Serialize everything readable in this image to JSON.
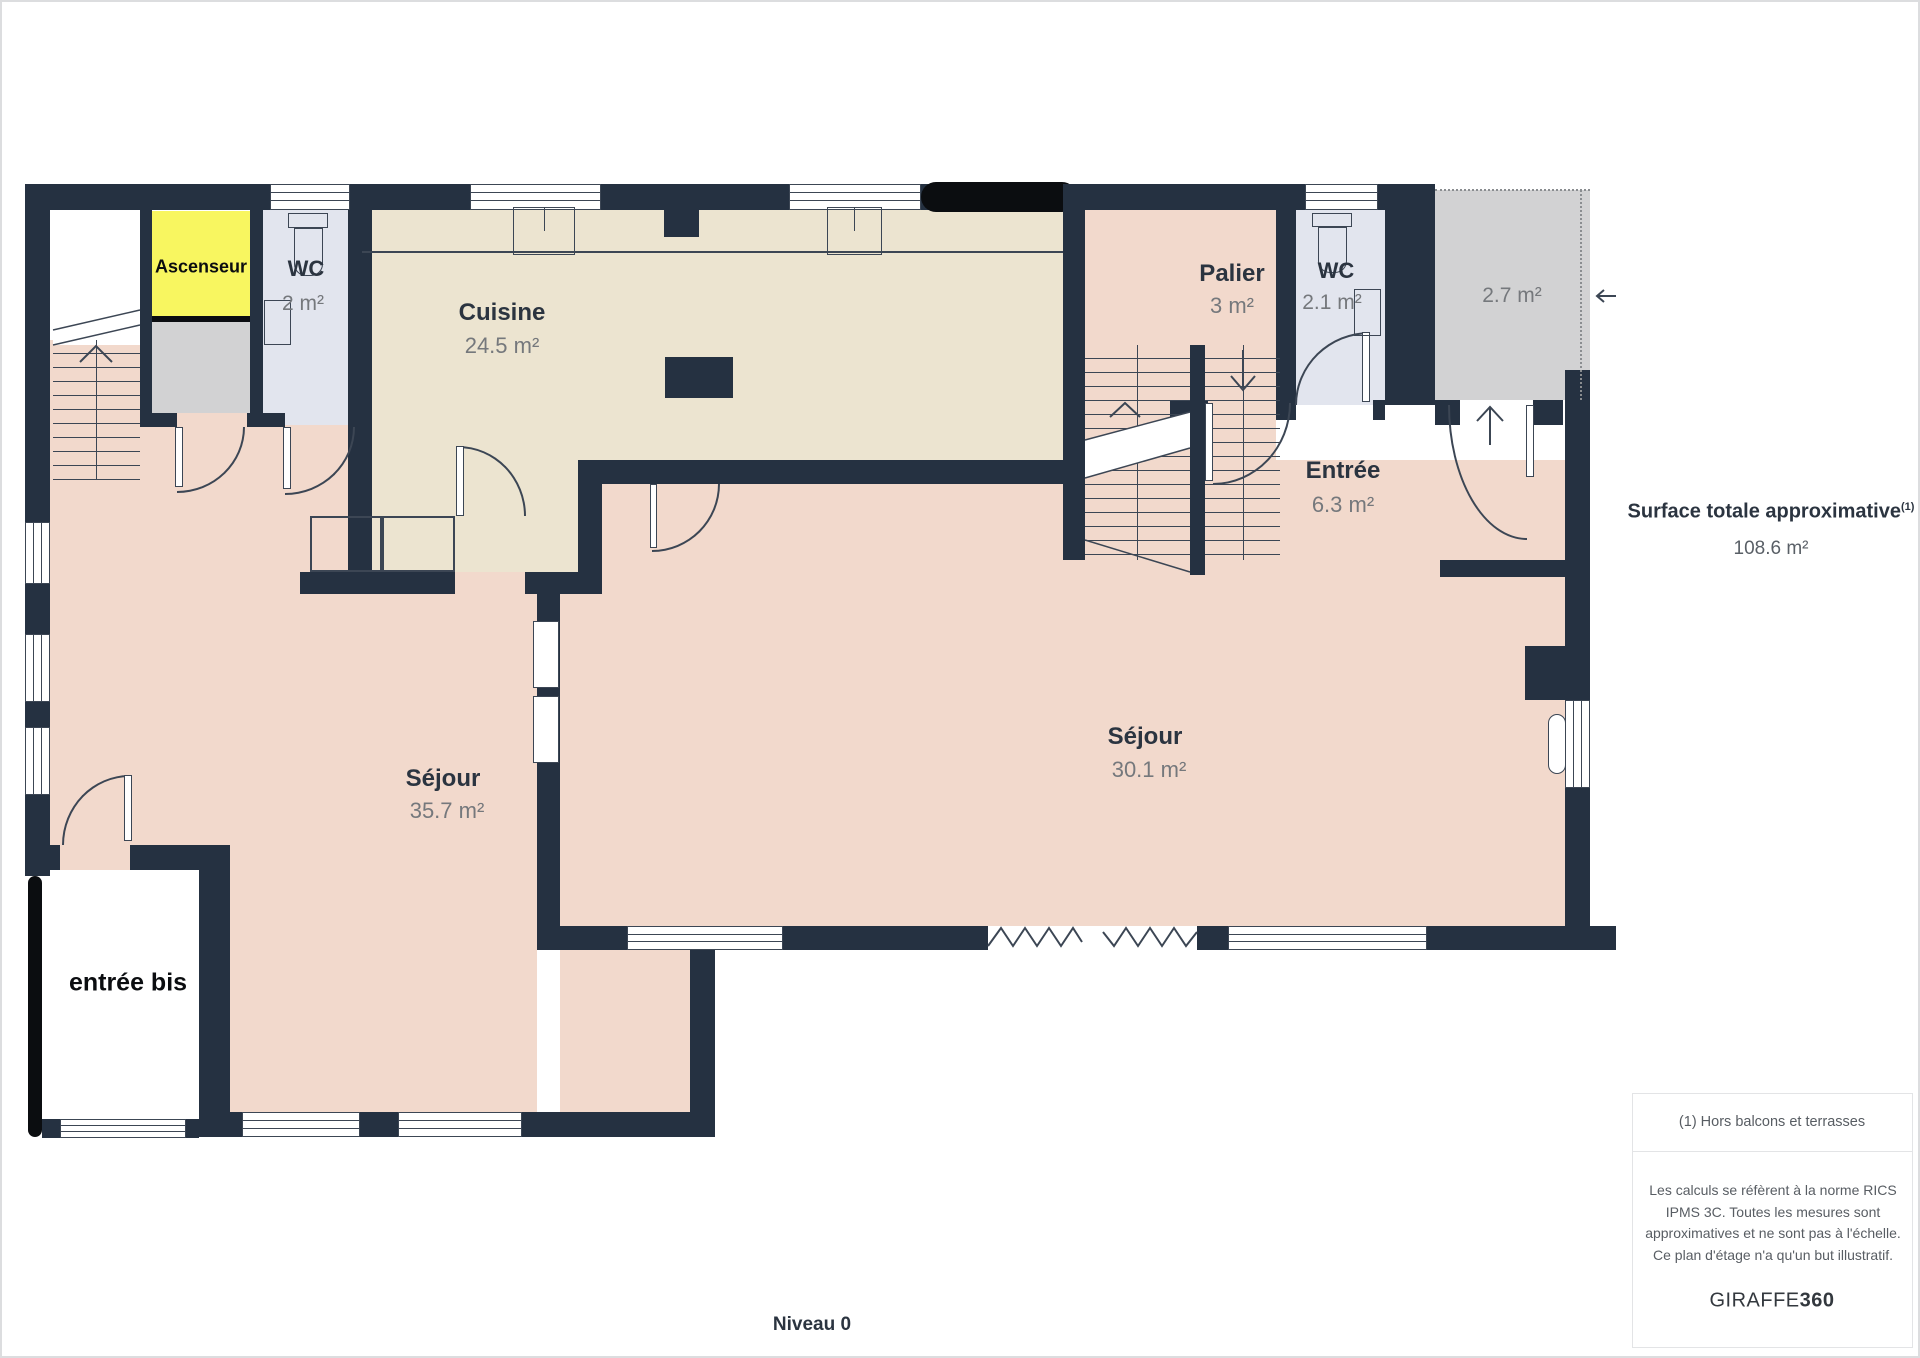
{
  "plan": {
    "rooms": [
      {
        "name": "Ascenseur",
        "area": ""
      },
      {
        "name": "WC",
        "area": "2 m²"
      },
      {
        "name": "Cuisine",
        "area": "24.5 m²"
      },
      {
        "name": "Palier",
        "area": "3 m²"
      },
      {
        "name": "WC",
        "area": "2.1 m²"
      },
      {
        "name": "",
        "area": "2.7 m²"
      },
      {
        "name": "Entrée",
        "area": "6.3 m²"
      },
      {
        "name": "Séjour",
        "area": "35.7 m²"
      },
      {
        "name": "Séjour",
        "area": "30.1 m²"
      },
      {
        "name": "entrée bis",
        "area": ""
      }
    ],
    "colors": {
      "wall": "#253141",
      "room_pink": "#f2d9cc",
      "room_beige": "#ece4d0",
      "room_lavender": "#e2e5ee",
      "room_gray": "#d2d2d3",
      "elevator_yellow": "#f8f660",
      "line": "#3c4654"
    }
  },
  "sidebar": {
    "title": "Surface totale approximative",
    "title_sup": "(1)",
    "total": "108.6 m²",
    "footnote": "(1) Hors balcons et terrasses",
    "legal": "Les calculs se réfèrent à la norme RICS IPMS 3C. Toutes les mesures sont approximatives et ne sont pas à l'échelle. Ce plan d'étage n'a qu'un but illustratif.",
    "brand": "GIRAFFE",
    "brand_bold": "360"
  },
  "footer": {
    "level": "Niveau 0"
  }
}
